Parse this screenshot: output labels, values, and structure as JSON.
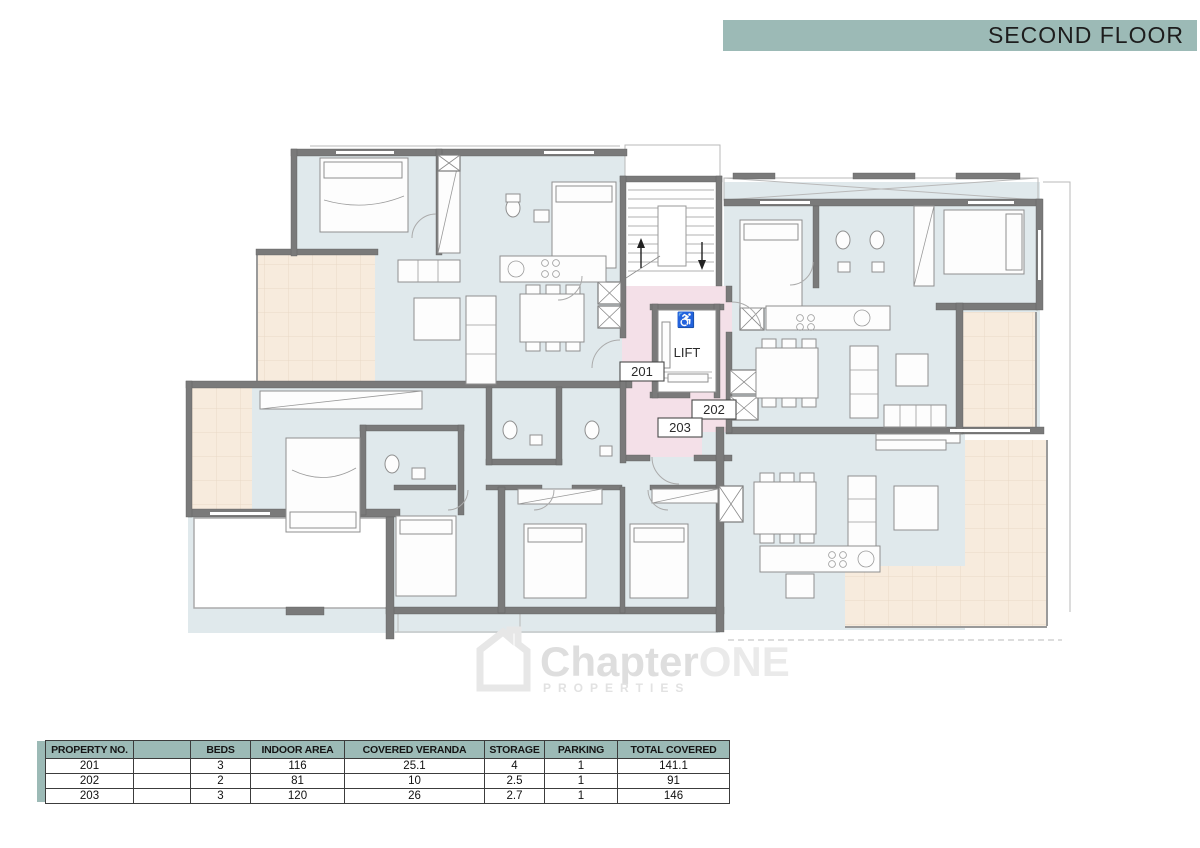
{
  "banner": {
    "title": "SECOND FLOOR",
    "color": "#9cbab6"
  },
  "floor_plan": {
    "lift_label": "LIFT",
    "wheelchair_icon": "♿",
    "unit_labels": {
      "u201": "201",
      "u202": "202",
      "u203": "203"
    },
    "colors": {
      "room": "#e0e9ec",
      "veranda": "#f7ebdd",
      "lobby": "#f4e0e8",
      "wall": "#7a7a7a"
    }
  },
  "watermark": {
    "brand": "Chapter",
    "brand_suffix": "ONE",
    "subtitle": "PROPERTIES"
  },
  "table": {
    "headers": [
      "PROPERTY NO.",
      "",
      "BEDS",
      "INDOOR AREA",
      "COVERED VERANDA",
      "STORAGE",
      "PARKING",
      "TOTAL COVERED"
    ],
    "rows": [
      [
        "201",
        "",
        "3",
        "116",
        "25.1",
        "4",
        "1",
        "141.1"
      ],
      [
        "202",
        "",
        "2",
        "81",
        "10",
        "2.5",
        "1",
        "91"
      ],
      [
        "203",
        "",
        "3",
        "120",
        "26",
        "2.7",
        "1",
        "146"
      ]
    ]
  }
}
